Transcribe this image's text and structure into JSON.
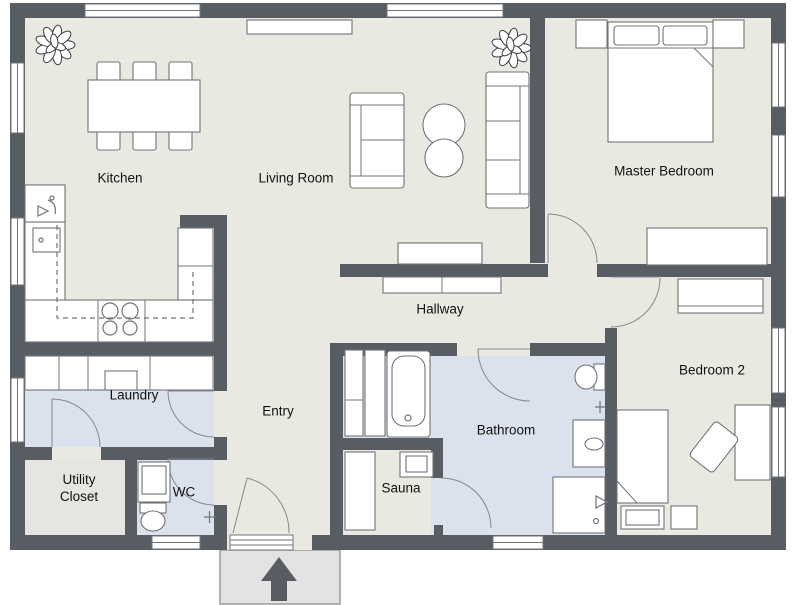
{
  "plan": {
    "title": "Apartment floor plan",
    "colors": {
      "wall": "#585d64",
      "floor": "#eae9e1",
      "wet": "#dce2ed",
      "utility": "#e6e5e1",
      "porch": "#e3e3e3",
      "outline": "#70747a",
      "arc": "#84888e",
      "text": "#111111"
    },
    "rooms": [
      {
        "id": "kitchen",
        "label": "Kitchen"
      },
      {
        "id": "living-room",
        "label": "Living Room"
      },
      {
        "id": "master-bedroom",
        "label": "Master Bedroom"
      },
      {
        "id": "hallway",
        "label": "Hallway"
      },
      {
        "id": "laundry",
        "label": "Laundry"
      },
      {
        "id": "entry",
        "label": "Entry"
      },
      {
        "id": "bathroom",
        "label": "Bathroom"
      },
      {
        "id": "sauna",
        "label": "Sauna"
      },
      {
        "id": "bedroom-2",
        "label": "Bedroom 2"
      },
      {
        "id": "utility-closet",
        "label": "Utility Closet"
      },
      {
        "id": "wc",
        "label": "WC"
      }
    ],
    "icons": [
      {
        "id": "entrance-arrow",
        "meaning": "main entrance direction"
      },
      {
        "id": "plant",
        "meaning": "potted plant"
      }
    ]
  }
}
